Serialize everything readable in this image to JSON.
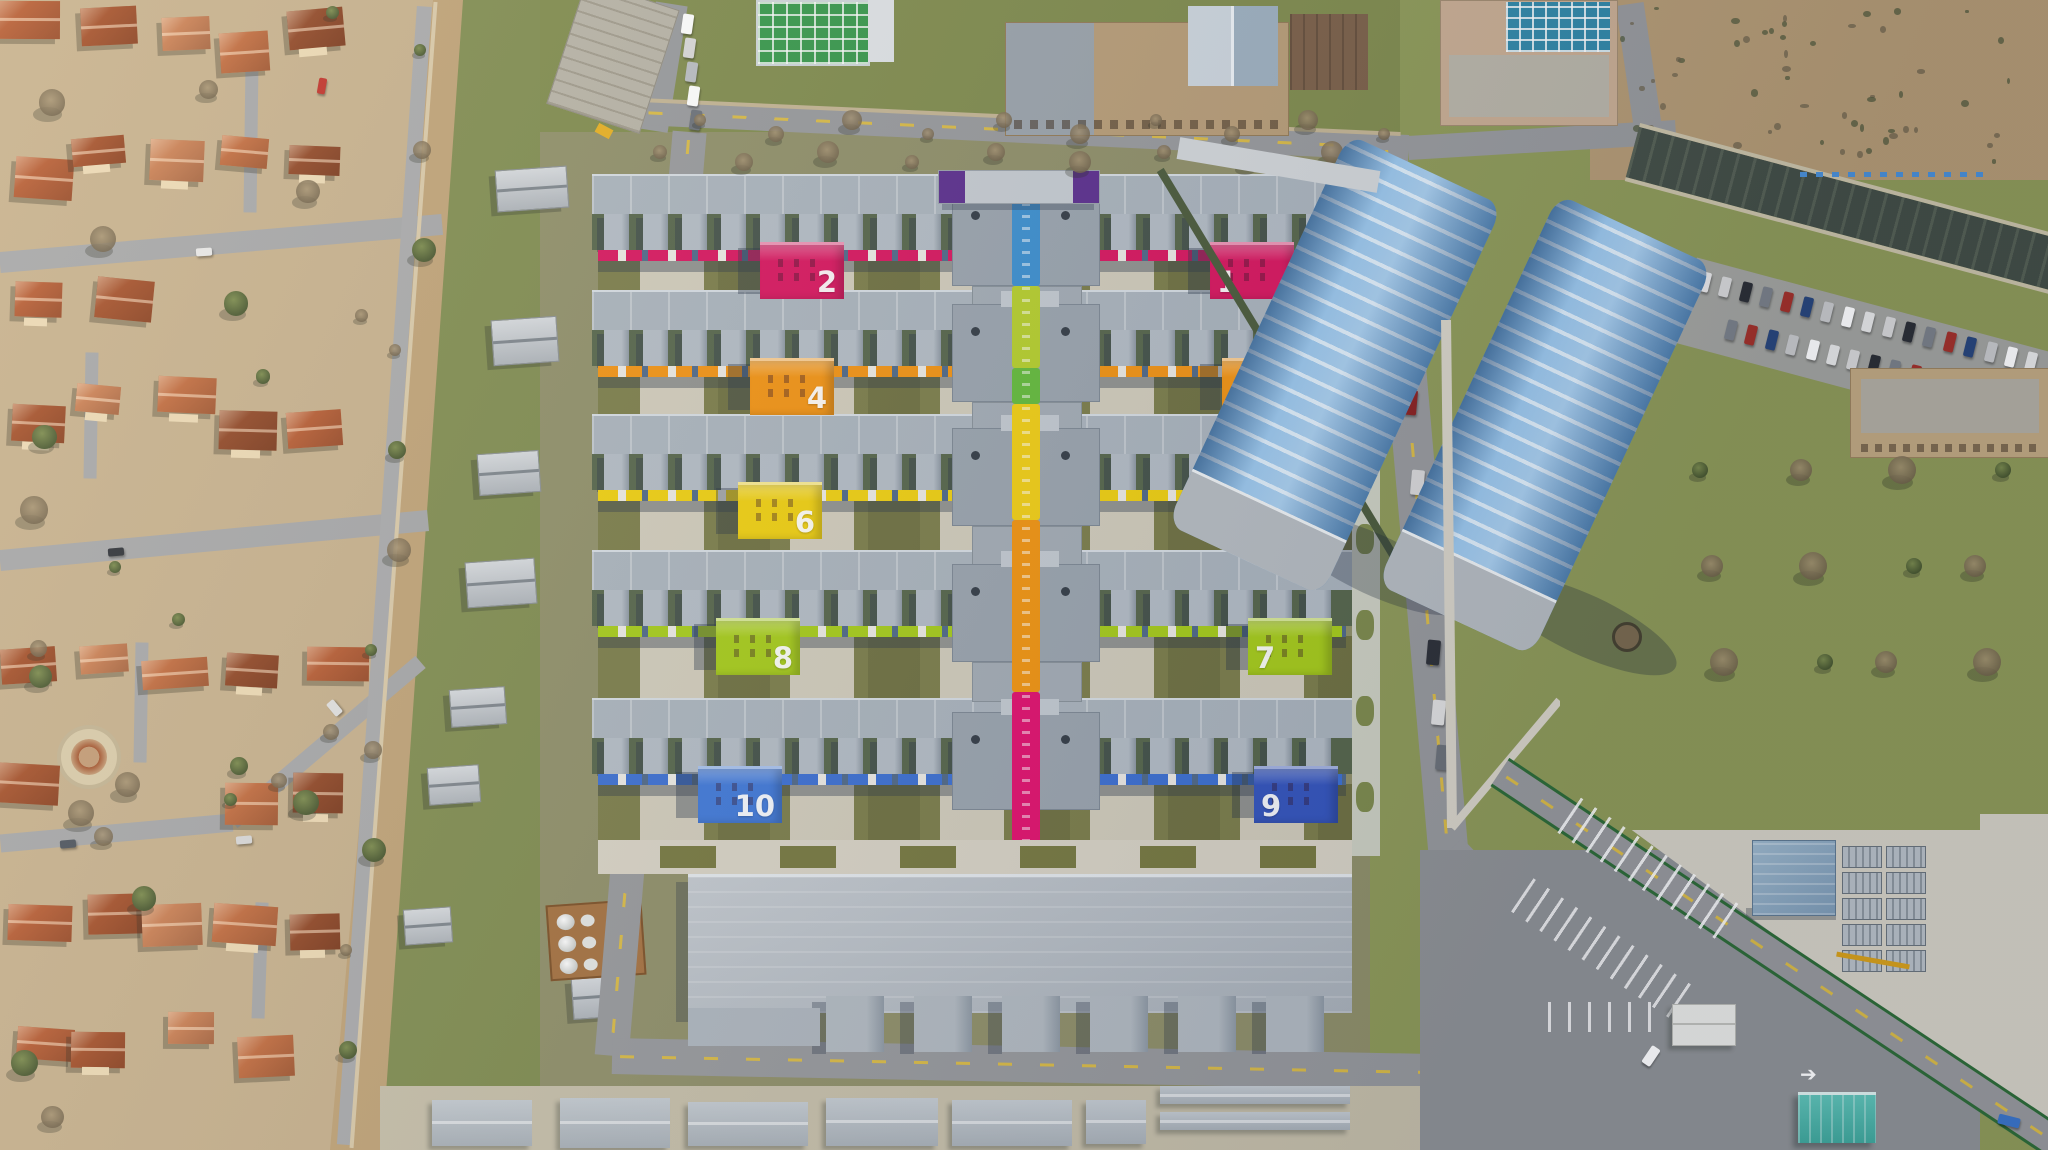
{
  "scene": {
    "type": "aerial-photograph",
    "description": "Winter drone view of a large modular campus of long grey slab buildings with ten colour-coded numbered end blocks and a rainbow central spine corridor, a terracotta-roof villa district on the west, twin blue barrel-vault halls, woodland, a canal and car parks on the east",
    "season_light": "bare winter trees, low sun with long shadows"
  },
  "campus": {
    "building_rows": [
      {
        "row": 1,
        "color_name": "crimson",
        "hex": "#d9145e",
        "west": {
          "number": "2"
        },
        "east": {
          "number": "1"
        }
      },
      {
        "row": 2,
        "color_name": "orange",
        "hex": "#f39311",
        "west": {
          "number": "4"
        },
        "east": {
          "number": "3"
        }
      },
      {
        "row": 3,
        "color_name": "yellow",
        "hex": "#f0d00e",
        "west": {
          "number": "6"
        },
        "east": {
          "number": "5"
        }
      },
      {
        "row": 4,
        "color_name": "lime",
        "hex": "#a6cc18",
        "west": {
          "number": "8"
        },
        "east": {
          "number": "7"
        }
      },
      {
        "row": 5,
        "color_name": "blue",
        "hex": "#3b6fd2",
        "west": {
          "number": "10",
          "hex": "#3f78d8"
        },
        "east": {
          "number": "9",
          "hex": "#3354bd"
        }
      }
    ],
    "spine_segments": [
      {
        "color_name": "blue",
        "hex": "#3b8fd0"
      },
      {
        "color_name": "yellow-green",
        "hex": "#b6cf2b"
      },
      {
        "color_name": "green",
        "hex": "#63bb3a"
      },
      {
        "color_name": "yellow",
        "hex": "#f2cf12"
      },
      {
        "color_name": "orange",
        "hex": "#f2940e"
      },
      {
        "color_name": "magenta",
        "hex": "#e20f6d"
      }
    ],
    "gate_building_color": "#5b2d8e",
    "roof_color": "#aab4bd",
    "tooth_color": "#b3bcc5",
    "wall_shadow_color": "#4e6888",
    "courtyard_color": "#7b7d49",
    "paving_color": "#d8d3c5"
  },
  "residential": {
    "roof_palette": [
      "#b55a31",
      "#c06a3d",
      "#a34e28",
      "#8f4524",
      "#c97e52"
    ],
    "wall_color": "#ecd9b4",
    "ground_color": "#c6b08c",
    "tree_color": "#5f6f3d",
    "approx_house_count": 44
  },
  "east_grounds": {
    "hall_roof": "#74b2e6",
    "hall_ribs": "#cfe6f8",
    "hall_end": "#b6bcc1",
    "hall_count": 2,
    "canal_color": "#424d44",
    "lawn_color": "#8e9a57",
    "concrete_color": "#d5d1c5",
    "solar_grid_color": "#2f87a8",
    "approx_parked_cars_top_lot": 30,
    "approx_parked_cars_campus_road": 10
  },
  "roads": {
    "asphalt": "#97999c",
    "lane_marking_yellow": "#dabb45",
    "parking_stripe_white": "#ffffff",
    "fence_green": "#2c6b36"
  },
  "labels": {
    "building_numbers": [
      "1",
      "2",
      "3",
      "4",
      "5",
      "6",
      "7",
      "8",
      "9",
      "10"
    ]
  }
}
